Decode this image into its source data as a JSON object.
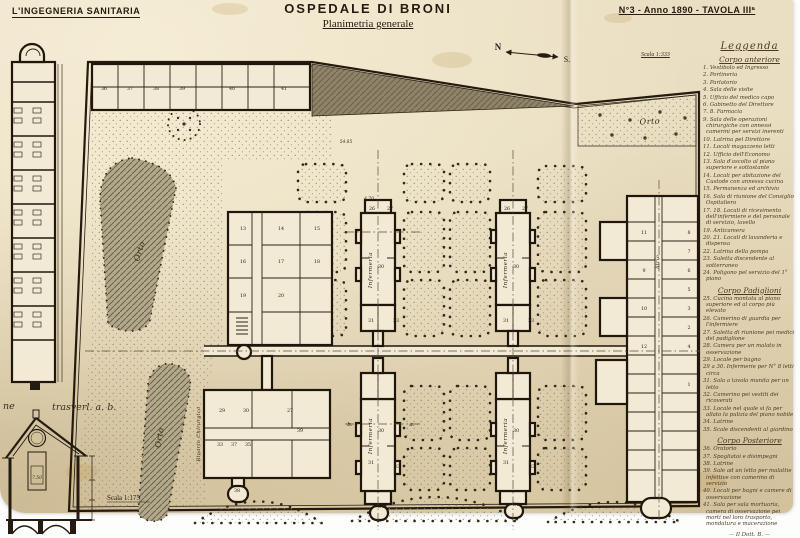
{
  "header": {
    "journal": "L'INGEGNERIA SANITARIA",
    "title": "OSPEDALE DI BRONI",
    "subtitle": "Planimetria generale",
    "issue": "N°3 - Anno 1890 - TAVOLA IIIª"
  },
  "compass": {
    "north": "N",
    "south": "S."
  },
  "scales": {
    "plan": "Scala 1:333",
    "section": "Scala 1:175"
  },
  "section_caption": {
    "left": "ne",
    "right": "trasverl. a. b."
  },
  "plan_labels": {
    "orchard": "Orto",
    "garden_upper": "Orto",
    "garden_lower": "Orto",
    "pavilion": "Infermeria",
    "surgical_ward": "Riparto Chirurgico",
    "atrium": "Atrio"
  },
  "dimensions": [
    {
      "t": "54.85",
      "x": 346,
      "y": 143
    },
    {
      "t": "4.70",
      "x": 369,
      "y": 200
    },
    {
      "t": "7.50",
      "x": 37,
      "y": 479
    }
  ],
  "section_markers": [
    {
      "t": "b.",
      "x": 350,
      "y": 426
    },
    {
      "t": "a.",
      "x": 412,
      "y": 426
    },
    {
      "t": "c.",
      "x": 379,
      "y": 522
    }
  ],
  "room_numbers": [
    {
      "n": "36",
      "x": 104,
      "y": 90
    },
    {
      "n": "37",
      "x": 130,
      "y": 90
    },
    {
      "n": "38",
      "x": 156,
      "y": 90
    },
    {
      "n": "39",
      "x": 182,
      "y": 90
    },
    {
      "n": "40",
      "x": 232,
      "y": 90
    },
    {
      "n": "41",
      "x": 284,
      "y": 90
    },
    {
      "n": "13",
      "x": 243,
      "y": 230
    },
    {
      "n": "14",
      "x": 281,
      "y": 230
    },
    {
      "n": "15",
      "x": 317,
      "y": 230
    },
    {
      "n": "16",
      "x": 243,
      "y": 263
    },
    {
      "n": "17",
      "x": 281,
      "y": 263
    },
    {
      "n": "18",
      "x": 317,
      "y": 263
    },
    {
      "n": "19",
      "x": 243,
      "y": 297
    },
    {
      "n": "20",
      "x": 281,
      "y": 297
    },
    {
      "n": "29",
      "x": 222,
      "y": 412
    },
    {
      "n": "30",
      "x": 246,
      "y": 412
    },
    {
      "n": "27",
      "x": 290,
      "y": 412
    },
    {
      "n": "33",
      "x": 220,
      "y": 446
    },
    {
      "n": "37",
      "x": 234,
      "y": 446
    },
    {
      "n": "35",
      "x": 248,
      "y": 446
    },
    {
      "n": "39",
      "x": 300,
      "y": 432
    },
    {
      "n": "38",
      "x": 237,
      "y": 492
    },
    {
      "n": "26",
      "x": 372,
      "y": 210
    },
    {
      "n": "27",
      "x": 390,
      "y": 210
    },
    {
      "n": "26",
      "x": 507,
      "y": 210
    },
    {
      "n": "27",
      "x": 525,
      "y": 210
    },
    {
      "n": "30",
      "x": 381,
      "y": 268
    },
    {
      "n": "30",
      "x": 516,
      "y": 268
    },
    {
      "n": "31",
      "x": 371,
      "y": 322
    },
    {
      "n": "33",
      "x": 396,
      "y": 322
    },
    {
      "n": "31",
      "x": 506,
      "y": 322
    },
    {
      "n": "33",
      "x": 531,
      "y": 322
    },
    {
      "n": "30",
      "x": 381,
      "y": 432
    },
    {
      "n": "30",
      "x": 516,
      "y": 432
    },
    {
      "n": "31",
      "x": 371,
      "y": 464
    },
    {
      "n": "33",
      "x": 397,
      "y": 468
    },
    {
      "n": "34",
      "x": 381,
      "y": 508
    },
    {
      "n": "31",
      "x": 506,
      "y": 464
    },
    {
      "n": "33",
      "x": 532,
      "y": 468
    },
    {
      "n": "34",
      "x": 516,
      "y": 506
    },
    {
      "n": "8",
      "x": 689,
      "y": 234
    },
    {
      "n": "7",
      "x": 689,
      "y": 253
    },
    {
      "n": "6",
      "x": 689,
      "y": 272
    },
    {
      "n": "5",
      "x": 689,
      "y": 291
    },
    {
      "n": "3",
      "x": 689,
      "y": 310
    },
    {
      "n": "2",
      "x": 689,
      "y": 329
    },
    {
      "n": "4",
      "x": 689,
      "y": 348
    },
    {
      "n": "1",
      "x": 689,
      "y": 386
    },
    {
      "n": "11",
      "x": 644,
      "y": 234
    },
    {
      "n": "9",
      "x": 644,
      "y": 272
    },
    {
      "n": "10",
      "x": 644,
      "y": 310
    },
    {
      "n": "12",
      "x": 644,
      "y": 348
    }
  ],
  "legend": {
    "title": "Leggenda",
    "sections": [
      {
        "heading": "Corpo anteriore",
        "items": [
          "1. Vestibolo ed Ingresso",
          "2. Portineria",
          "3. Parlatorio",
          "4. Sala delle visite",
          "5. Ufficio del medico capo",
          "6. Gabinetto del Direttore",
          "7. 8. Farmacia",
          "9. Sala delle operazioni chirurgiche con annessi camerini per servizi inerenti",
          "10. Latrina pel Direttore",
          "11. Locali magazzeno letti",
          "12. Ufficio dell'Economo",
          "13. Sala d'ascolto al piano superiore e sottostante",
          "14. Locali per abitazione del Custode con annessa cucina",
          "15. Permanenza ed archivio",
          "16. Sala di riunione del Consiglio Ospitaliero",
          "17. 18. Locali di ricevimento dell'infermiere e del personale di servizio, lavello",
          "19. Anticamera",
          "20. 21. Locali di lavanderia e dispensa",
          "22. Latrina della pompa",
          "23. Saletta discendente al sotterraneo",
          "24. Poligono pel servizio del 1° piano"
        ]
      },
      {
        "heading": "Corpo Padiglioni",
        "items": [
          "25. Cucina montata al piano superiore ed al corpo più elevato",
          "26. Camerino di guardia per l'infermiere",
          "27. Saletta di riunione pei medici del padiglione",
          "28. Camera per un malato in osservazione",
          "29. Locale per bagno",
          "29 a 30. Infermerie per N° 8 letti circa",
          "31. Sala a tavola munita per un letto",
          "32. Camerino pei vestiti dei ricoverati",
          "33. Locale nel quale si fa per allato la pulizia del piano nobile",
          "34. Latrine",
          "35. Scale discendenti al giardino"
        ]
      },
      {
        "heading": "Corpo Posteriore",
        "items": [
          "36. Oratorio",
          "37. Spogliatoi e disimpegni",
          "38. Latrine",
          "39. Sale ad un letto per malattie infettive con camerino di servizio",
          "40. Locali per bagni e camere di osservazione",
          "41. Sala per sala mortuaria, camera di osservazione pei morti nel loro trasporto, mondatura e macerazione"
        ]
      }
    ],
    "signature": "— Il Dott. B. —"
  }
}
